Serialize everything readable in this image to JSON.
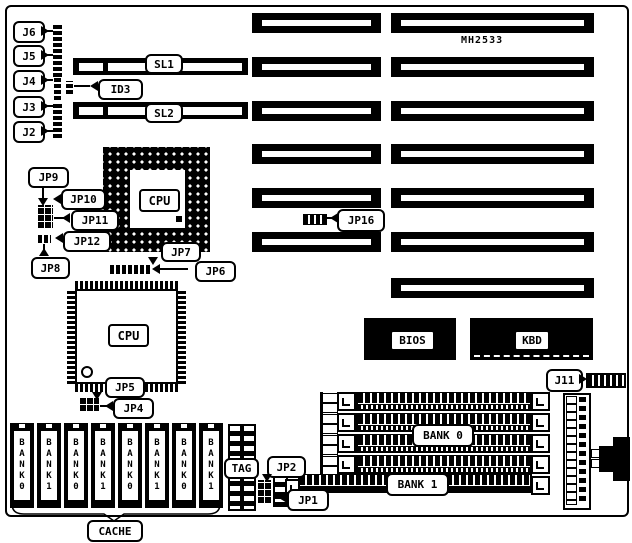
{
  "diagram": {
    "model": "MH2533",
    "labels": {
      "j6": "J6",
      "j5": "J5",
      "j4": "J4",
      "j3": "J3",
      "j2": "J2",
      "sl1": "SL1",
      "sl2": "SL2",
      "id3": "ID3",
      "jp9": "JP9",
      "jp10": "JP10",
      "jp11": "JP11",
      "jp12": "JP12",
      "jp8": "JP8",
      "jp7": "JP7",
      "jp6": "JP6",
      "jp16": "JP16",
      "cpu_pga": "CPU",
      "cpu_qfp": "CPU",
      "jp5": "JP5",
      "jp4": "JP4",
      "bios": "BIOS",
      "kbd": "KBD",
      "j11": "J11",
      "bank0": "BANK 0",
      "bank1": "BANK 1",
      "tag": "TAG",
      "jp2": "JP2",
      "jp1": "JP1",
      "cache": "CACHE"
    },
    "cache_chips": [
      "BANK0",
      "BANK1",
      "BANK0",
      "BANK1",
      "BANK0",
      "BANK1",
      "BANK0",
      "BANK1"
    ],
    "colors": {
      "line": "#000000",
      "background": "#ffffff"
    }
  }
}
